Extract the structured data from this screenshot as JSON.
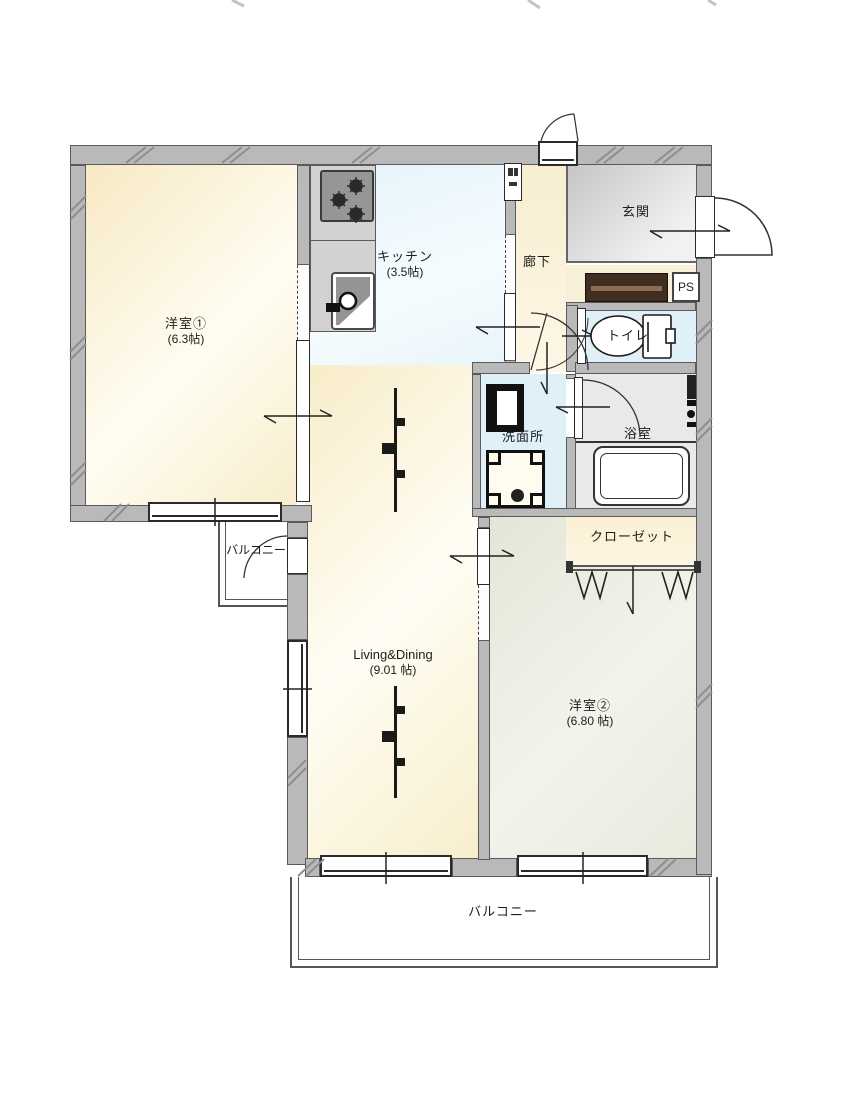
{
  "plan": {
    "rooms": {
      "bedroom1": {
        "name": "洋室①",
        "size": "(6.3帖)"
      },
      "kitchen": {
        "name": "キッチン",
        "size": "(3.5帖)"
      },
      "hallway": {
        "name": "廊下"
      },
      "entrance": {
        "name": "玄関"
      },
      "pipe_space": {
        "name": "PS"
      },
      "toilet": {
        "name": "トイレ"
      },
      "washroom": {
        "name": "洗面所"
      },
      "bathroom": {
        "name": "浴室"
      },
      "closet": {
        "name": "クローゼット"
      },
      "living_dining": {
        "name": "Living&Dining",
        "size": "(9.01 帖)"
      },
      "bedroom2": {
        "name": "洋室②",
        "size": "(6.80 帖)"
      },
      "balcony_side": {
        "name": "バルコニー"
      },
      "balcony_main": {
        "name": "バルコニー"
      }
    },
    "colors": {
      "wall": "#b9b9b9",
      "room_cream": "#faf0d6",
      "kitchen_blue": "#e9f5fa",
      "water_blue": "#dff0f8",
      "bath_gray": "#e9e9e9",
      "bedroom2_green": "#e7eadd",
      "entrance_gray": "#d6d6d6",
      "cabinet_brown": "#402e20"
    }
  }
}
